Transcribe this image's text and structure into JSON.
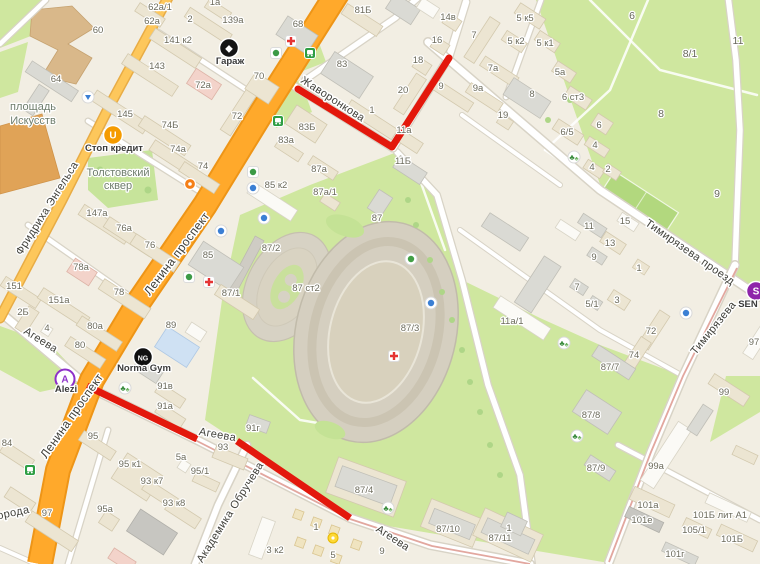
{
  "map": {
    "colors": {
      "route": "#e3180c",
      "road_major_fill": "#ffa92b",
      "road_major_casing": "#ee9517",
      "road_secondary_fill": "#fdc75b",
      "park_green": "#cfe79f",
      "tram_line": "#e2a79f",
      "building_cream": "#ece5d2"
    },
    "street_labels": [
      {
        "t": "Жаворонкова",
        "x": 331,
        "y": 102,
        "rot": 33,
        "s": 11
      },
      {
        "t": "Ленина проспект",
        "x": 180,
        "y": 256,
        "rot": -53,
        "s": 12
      },
      {
        "t": "Ленина проспект",
        "x": 75,
        "y": 418,
        "rot": -55,
        "s": 12
      },
      {
        "t": "Фридриха Энгельса",
        "x": 50,
        "y": 210,
        "rot": -58,
        "s": 11
      },
      {
        "t": "Агеева",
        "x": 39,
        "y": 343,
        "rot": 32,
        "s": 11
      },
      {
        "t": "Агеева",
        "x": 217,
        "y": 438,
        "rot": 10,
        "s": 11
      },
      {
        "t": "Агеева",
        "x": 391,
        "y": 541,
        "rot": 33,
        "s": 11
      },
      {
        "t": "Академика Обручева",
        "x": 233,
        "y": 514,
        "rot": -58,
        "s": 11
      },
      {
        "t": "Тимирязева проезд",
        "x": 688,
        "y": 255,
        "rot": 35,
        "s": 11
      },
      {
        "t": "Тимирязева",
        "x": 716,
        "y": 330,
        "rot": -51,
        "s": 11
      },
      {
        "t": "орода",
        "x": 14,
        "y": 516,
        "rot": -12,
        "s": 11
      }
    ],
    "place_labels": [
      {
        "t": "площадь",
        "x": 33,
        "y": 110
      },
      {
        "t": "Искусств",
        "x": 33,
        "y": 124
      },
      {
        "t": "Толстовский",
        "x": 118,
        "y": 176
      },
      {
        "t": "сквер",
        "x": 118,
        "y": 189
      }
    ],
    "park_labels": [
      [
        "6",
        632,
        19
      ],
      [
        "8/1",
        690,
        57
      ],
      [
        "11",
        738,
        44
      ],
      [
        "8",
        661,
        117
      ],
      [
        "9",
        717,
        197
      ]
    ],
    "building_labels": [
      [
        "62а/1",
        160,
        10
      ],
      [
        "62а",
        152,
        24
      ],
      [
        "1а",
        215,
        5
      ],
      [
        "2",
        190,
        22
      ],
      [
        "139а",
        233,
        23
      ],
      [
        "141 к2",
        178,
        43
      ],
      [
        "143",
        157,
        69
      ],
      [
        "60",
        98,
        33
      ],
      [
        "64",
        56,
        82
      ],
      [
        "72а",
        203,
        88
      ],
      [
        "145",
        125,
        117
      ],
      [
        "74Б",
        170,
        128
      ],
      [
        "72",
        237,
        119
      ],
      [
        "74а",
        178,
        152
      ],
      [
        "74",
        203,
        169
      ],
      [
        "68",
        298,
        27
      ],
      [
        "81Б",
        363,
        13
      ],
      [
        "83",
        342,
        67
      ],
      [
        "70",
        259,
        79
      ],
      [
        "83Б",
        307,
        130
      ],
      [
        "83а",
        286,
        143
      ],
      [
        "87а",
        319,
        172
      ],
      [
        "85 к2",
        276,
        188
      ],
      [
        "87а/1",
        325,
        195
      ],
      [
        "85",
        208,
        258
      ],
      [
        "87/2",
        271,
        251
      ],
      [
        "87/1",
        231,
        296
      ],
      [
        "87",
        377,
        221
      ],
      [
        "87 ст2",
        306,
        291
      ],
      [
        "87/3",
        410,
        331
      ],
      [
        "147а",
        97,
        216
      ],
      [
        "76а",
        124,
        231
      ],
      [
        "76",
        150,
        248
      ],
      [
        "78а",
        81,
        270
      ],
      [
        "78",
        119,
        295
      ],
      [
        "151",
        14,
        289
      ],
      [
        "151а",
        59,
        303
      ],
      [
        "2Б",
        23,
        315
      ],
      [
        "80а",
        95,
        329
      ],
      [
        "80",
        80,
        348
      ],
      [
        "4",
        47,
        331
      ],
      [
        "89",
        171,
        328
      ],
      [
        "1",
        372,
        113
      ],
      [
        "20",
        403,
        93
      ],
      [
        "18",
        418,
        63
      ],
      [
        "16",
        437,
        43
      ],
      [
        "14в",
        448,
        20
      ],
      [
        "7",
        474,
        38
      ],
      [
        "9",
        441,
        89
      ],
      [
        "9а",
        478,
        91
      ],
      [
        "7а",
        493,
        71
      ],
      [
        "19",
        503,
        118
      ],
      [
        "11а",
        404,
        133
      ],
      [
        "11Б",
        403,
        164
      ],
      [
        "5 к5",
        525,
        21
      ],
      [
        "5 к2",
        516,
        44
      ],
      [
        "5 к1",
        545,
        46
      ],
      [
        "5а",
        560,
        75
      ],
      [
        "8",
        532,
        97
      ],
      [
        "6 ст3",
        573,
        100
      ],
      [
        "6/5",
        567,
        135
      ],
      [
        "6",
        599,
        128
      ],
      [
        "4",
        595,
        148
      ],
      [
        "4",
        592,
        170
      ],
      [
        "2",
        608,
        172
      ],
      [
        "11",
        589,
        229
      ],
      [
        "15",
        625,
        224
      ],
      [
        "13",
        610,
        246
      ],
      [
        "9",
        594,
        260
      ],
      [
        "1",
        639,
        271
      ],
      [
        "7",
        577,
        290
      ],
      [
        "3",
        617,
        303
      ],
      [
        "5/1",
        592,
        307
      ],
      [
        "11а/1",
        512,
        324
      ],
      [
        "72",
        651,
        334
      ],
      [
        "74",
        634,
        358
      ],
      [
        "87/7",
        610,
        370
      ],
      [
        "87/8",
        591,
        418
      ],
      [
        "87/9",
        596,
        471
      ],
      [
        "91г",
        253,
        431
      ],
      [
        "91в",
        165,
        389
      ],
      [
        "91а",
        165,
        409
      ],
      [
        "95",
        93,
        439
      ],
      [
        "95 к1",
        130,
        467
      ],
      [
        "93 к7",
        152,
        484
      ],
      [
        "93 к8",
        174,
        506
      ],
      [
        "5а",
        181,
        460
      ],
      [
        "95/1",
        200,
        474
      ],
      [
        "93",
        223,
        450
      ],
      [
        "95а",
        105,
        512
      ],
      [
        "97",
        47,
        516
      ],
      [
        "84",
        7,
        446
      ],
      [
        "87/4",
        364,
        493
      ],
      [
        "87/10",
        448,
        532
      ],
      [
        "87/11",
        500,
        541
      ],
      [
        "1",
        316,
        530
      ],
      [
        "3 к2",
        275,
        553
      ],
      [
        "5",
        333,
        558
      ],
      [
        "9",
        382,
        554
      ],
      [
        "99",
        724,
        395
      ],
      [
        "99а",
        656,
        469
      ],
      [
        "101а",
        648,
        508
      ],
      [
        "101е",
        642,
        523
      ],
      [
        "101Б лит А1",
        720,
        518
      ],
      [
        "105/1",
        694,
        533
      ],
      [
        "101Б",
        732,
        542
      ],
      [
        "101г",
        675,
        557
      ],
      [
        "97",
        754,
        345
      ],
      [
        "1",
        509,
        531
      ]
    ],
    "pois": [
      {
        "name": "garage-poi",
        "label": "Гараж",
        "glyph": "◆",
        "x": 229,
        "y": 48,
        "lx": 230,
        "ly": 64,
        "bg": "#141414",
        "fg": "#ffffff"
      },
      {
        "name": "stop-kredit-poi",
        "label": "Стоп кредит",
        "glyph": "U",
        "x": 113,
        "y": 135,
        "lx": 114,
        "ly": 151,
        "bg": "#f59b00",
        "fg": "#ffffff"
      },
      {
        "name": "norma-gym-poi",
        "label": "Norma Gym",
        "glyph": "NG",
        "x": 143,
        "y": 357,
        "lx": 144,
        "ly": 371,
        "bg": "#101010",
        "fg": "#ffffff"
      },
      {
        "name": "alezi-poi",
        "label": "Alezi",
        "glyph": "A",
        "x": 65,
        "y": 379,
        "lx": 66,
        "ly": 392,
        "bg": "#ffffff",
        "fg": "#8e30c9",
        "ring": "#8e30c9"
      },
      {
        "name": "sen-poi",
        "label": "SEN",
        "glyph": "S",
        "x": 756,
        "y": 291,
        "lx": 748,
        "ly": 307,
        "bg": "#8e24aa",
        "fg": "#ffffff"
      }
    ],
    "service_icons": [
      {
        "name": "pharmacy-icon",
        "x": 291,
        "y": 41,
        "type": "cross"
      },
      {
        "name": "pharmacy-icon",
        "x": 209,
        "y": 282,
        "type": "cross"
      },
      {
        "name": "pharmacy-icon",
        "x": 394,
        "y": 356,
        "type": "cross"
      },
      {
        "name": "shop-icon",
        "x": 276,
        "y": 53,
        "type": "green"
      },
      {
        "name": "shop-icon",
        "x": 189,
        "y": 277,
        "type": "green"
      },
      {
        "name": "supermarket-icon",
        "x": 253,
        "y": 172,
        "type": "green"
      },
      {
        "name": "food-icon",
        "x": 190,
        "y": 184,
        "type": "orange"
      },
      {
        "name": "education-icon",
        "x": 221,
        "y": 231,
        "type": "blue"
      },
      {
        "name": "education-icon",
        "x": 253,
        "y": 188,
        "type": "blue"
      },
      {
        "name": "education-icon",
        "x": 686,
        "y": 313,
        "type": "blue"
      },
      {
        "name": "sport-icon",
        "x": 431,
        "y": 303,
        "type": "blue"
      },
      {
        "name": "club-icon",
        "x": 264,
        "y": 218,
        "type": "blue"
      },
      {
        "name": "hotel-icon",
        "x": 411,
        "y": 259,
        "type": "greenround"
      },
      {
        "name": "underpass-icon",
        "x": 88,
        "y": 97,
        "type": "bluearrow"
      },
      {
        "name": "poi-icon",
        "x": 333,
        "y": 538,
        "type": "yellow"
      },
      {
        "name": "bus-stop-icon",
        "x": 310,
        "y": 53,
        "type": "bus"
      },
      {
        "name": "bus-stop-icon",
        "x": 278,
        "y": 121,
        "type": "bus"
      },
      {
        "name": "bus-stop-icon",
        "x": 30,
        "y": 470,
        "type": "bus"
      },
      {
        "name": "trees-icon",
        "x": 574,
        "y": 157,
        "type": "trees"
      },
      {
        "name": "trees-icon",
        "x": 564,
        "y": 343,
        "type": "trees"
      },
      {
        "name": "trees-icon",
        "x": 388,
        "y": 508,
        "type": "trees"
      },
      {
        "name": "trees-icon",
        "x": 577,
        "y": 436,
        "type": "trees"
      },
      {
        "name": "trees-icon",
        "x": 125,
        "y": 388,
        "type": "trees"
      }
    ],
    "route": {
      "color": "#e3180c",
      "streets": [
        "Жаворонкова",
        "Агеева"
      ]
    }
  }
}
